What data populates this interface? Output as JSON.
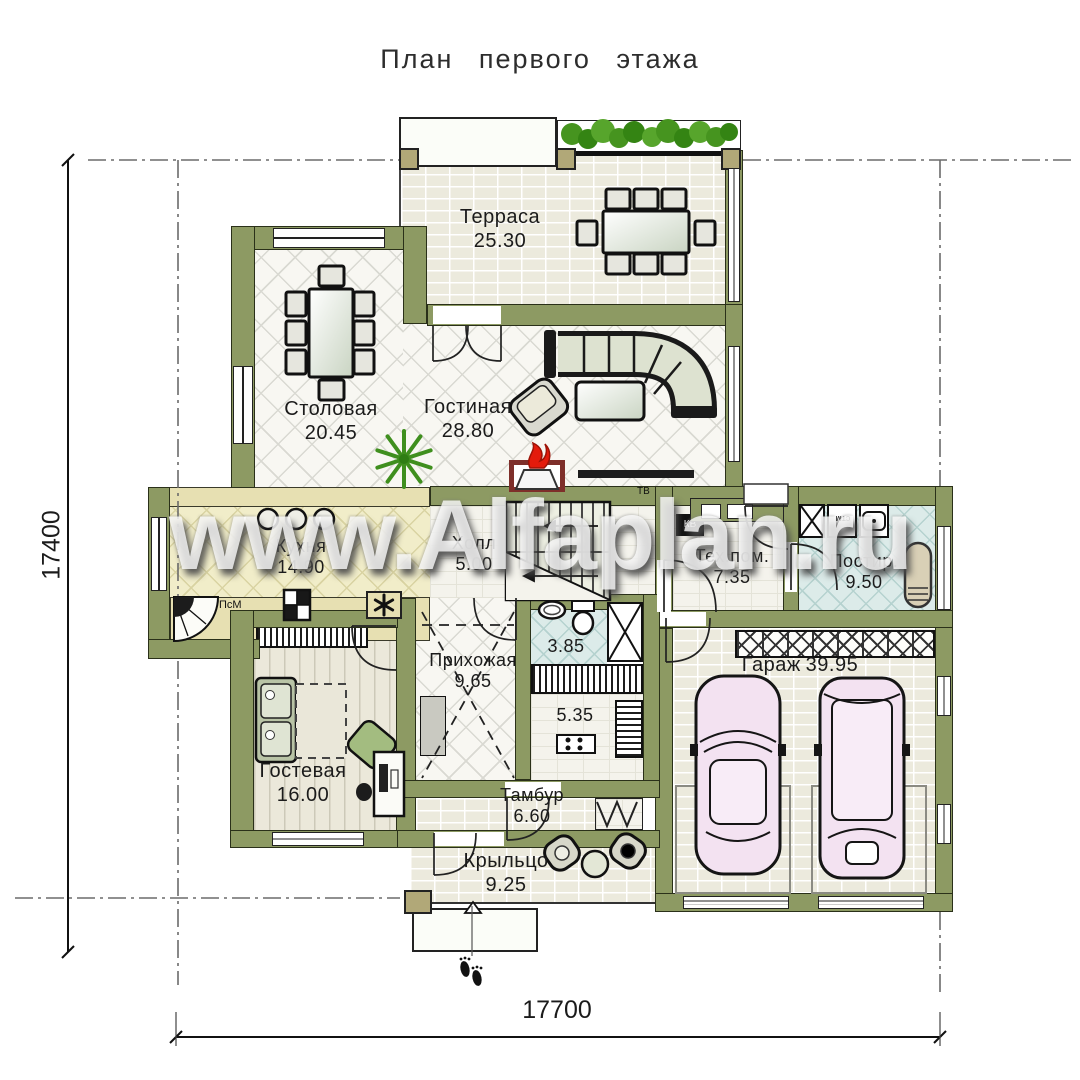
{
  "title": "План первого этажа",
  "watermark": "www.Alfaplan.ru",
  "rooms": {
    "terrace": {
      "name": "Терраса",
      "area": "25.30"
    },
    "dining": {
      "name": "Столовая",
      "area": "20.45"
    },
    "living": {
      "name": "Гостиная",
      "area": "28.80"
    },
    "kitchen": {
      "name": "Кухня",
      "area": "14.90"
    },
    "hall": {
      "name": "Холл",
      "area": "5.00"
    },
    "tech": {
      "name": "Тех.пом.",
      "area": "7.35"
    },
    "laundry": {
      "name": "Постир.",
      "area": "9.50"
    },
    "garage": {
      "name": "Гараж",
      "area": "39.95"
    },
    "entry": {
      "name": "Прихожая",
      "area": "9.65"
    },
    "bath": {
      "name": "",
      "area": "3.85"
    },
    "wardrobe": {
      "name": "",
      "area": "5.35"
    },
    "guest": {
      "name": "Гостевая",
      "area": "16.00"
    },
    "vestibule": {
      "name": "Тамбур",
      "area": "6.60"
    },
    "porch": {
      "name": "Крыльцо",
      "area": "9.25"
    }
  },
  "dimensions": {
    "width": "17700",
    "height": "17400"
  },
  "appliances": {
    "dishwasher": "ПсМ",
    "tv": "ТВ",
    "electrical": "КВ",
    "washer": "стм"
  },
  "colors": {
    "wall": "#8d9a63",
    "floor": "#eceadd",
    "kitchen_floor": "#f1edc9",
    "wet_floor": "#dcebe9",
    "car": "#f3e2f1",
    "plant": "#3f8f1e",
    "fire": "#e31b0c",
    "fireplace": "#7e2f2a"
  }
}
